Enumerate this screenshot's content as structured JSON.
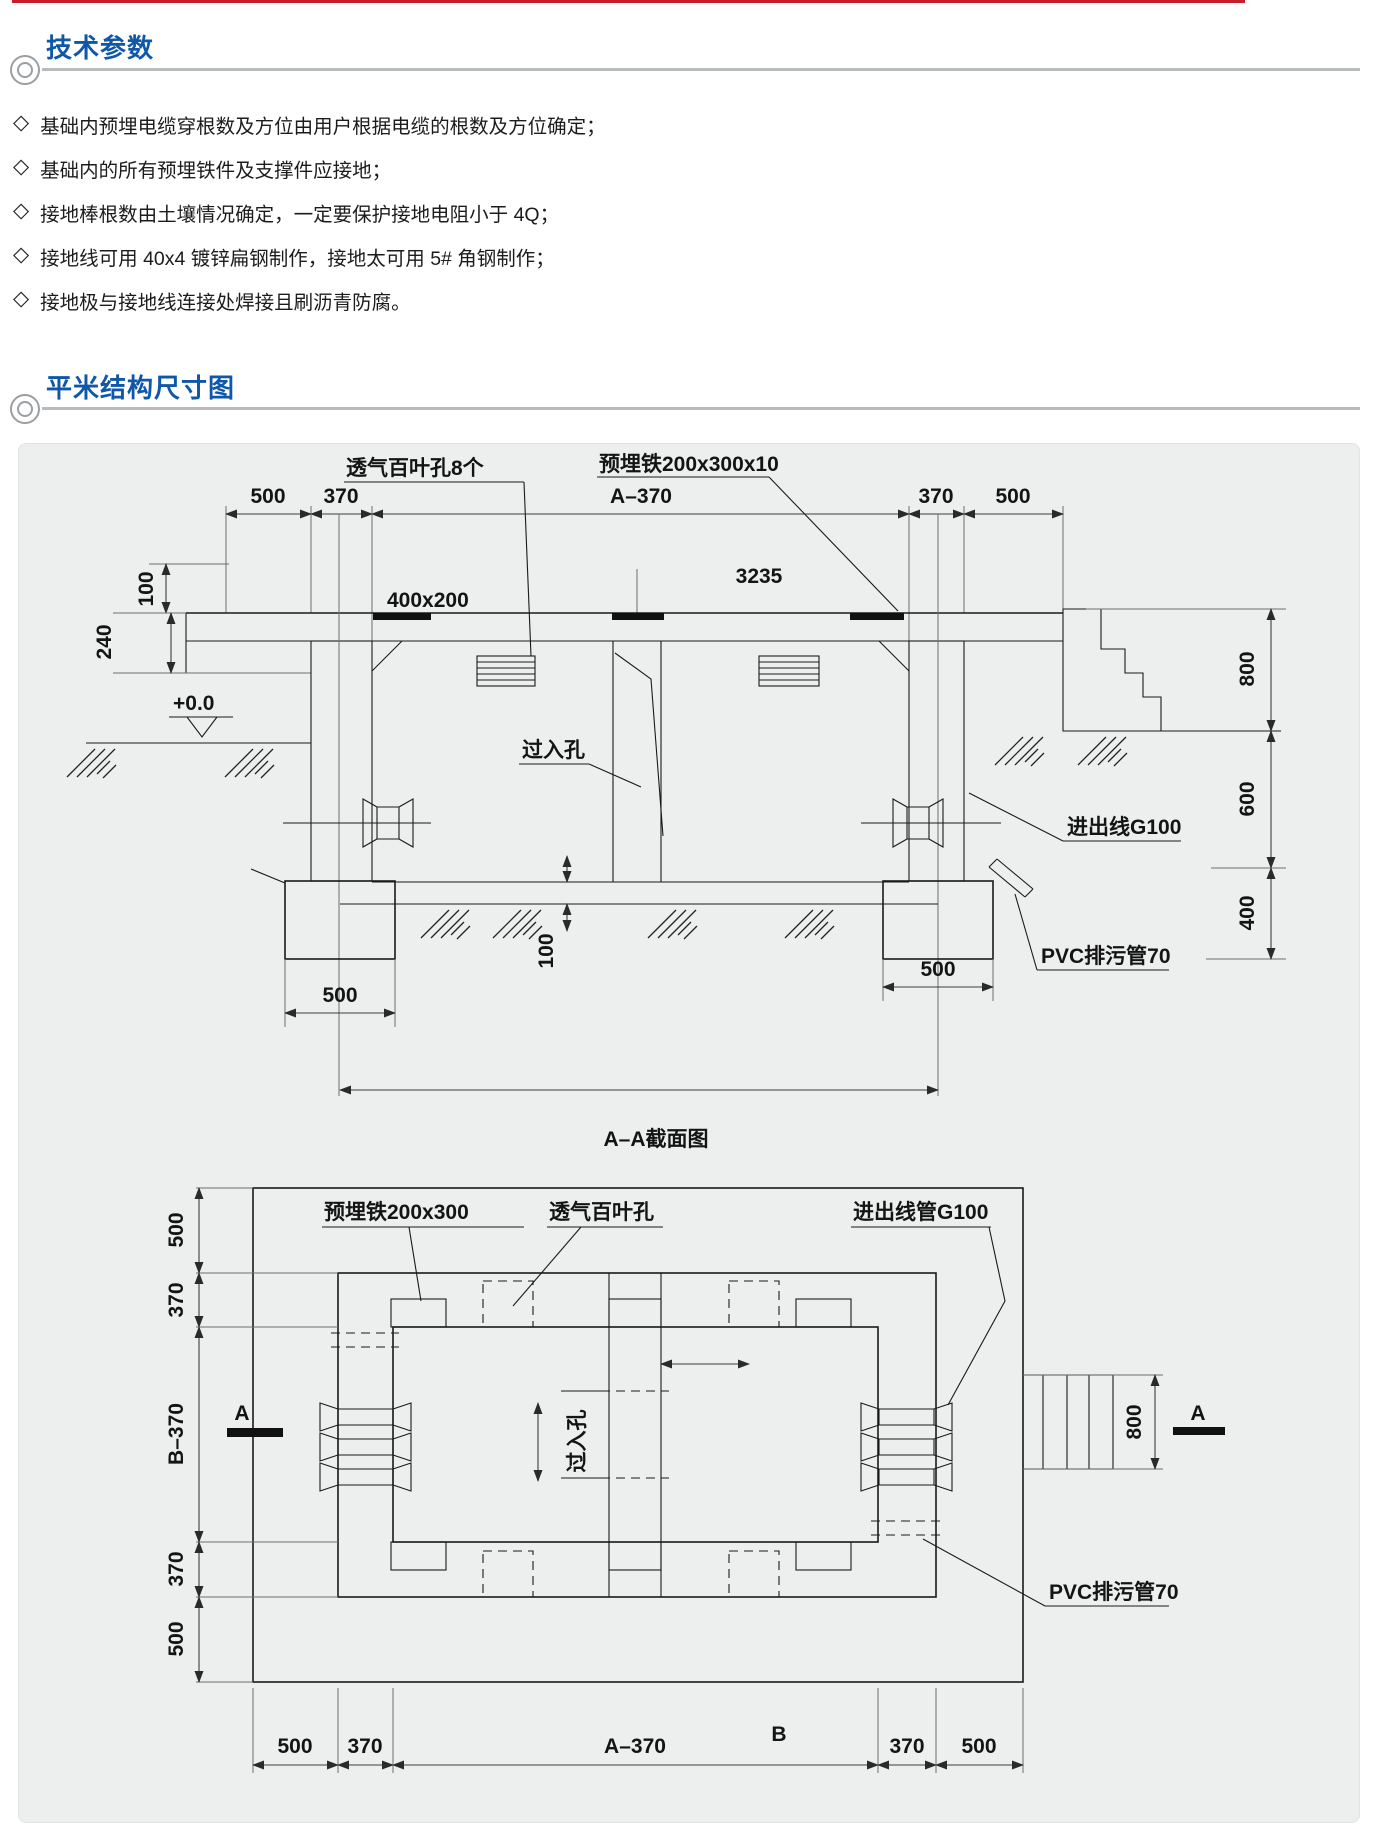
{
  "header": {
    "section1_title": "技术参数",
    "section2_title": "平米结构尺寸图",
    "bullet_char": "◇"
  },
  "bullets": [
    "基础内预埋电缆穿根数及方位由用户根据电缆的根数及方位确定；",
    "基础内的所有预埋铁件及支撑件应接地；",
    "接地棒根数由土壤情况确定，一定要保护接地电阻小于 4Q；",
    "接地线可用 40x4 镀锌扁钢制作，接地太可用 5# 角钢制作；",
    "接地极与接地线连接处焊接且刷沥青防腐。"
  ],
  "section_view": {
    "caption": "A–A截面图",
    "top_dims": [
      "500",
      "370",
      "A–370",
      "370",
      "500"
    ],
    "dim_100_roof": "100",
    "dim_240": "240",
    "level": "+0.0",
    "plate_size": "400x200",
    "total": "3235",
    "louver_label": "透气百叶孔8个",
    "plate_label": "预埋铁200x300x10",
    "manhole_label": "过入孔",
    "cable_label": "进出线G100",
    "pvc_label": "PVC排污管70",
    "right_dims": [
      "800",
      "600",
      "400"
    ],
    "footing_dim_left": "500",
    "footing_dim_right": "500",
    "floor_dim": "100"
  },
  "plan_view": {
    "label_b": "B",
    "left_dims": [
      "500",
      "370",
      "B–370",
      "370",
      "500"
    ],
    "bottom_dims": [
      "500",
      "370",
      "A–370",
      "370",
      "500"
    ],
    "plate_label": "预埋铁200x300",
    "louver_label": "透气百叶孔",
    "conduit_label": "进出线管G100",
    "pvc_label": "PVC排污管70",
    "manhole_label": "过入孔",
    "dim_800": "800",
    "marker_left": "A",
    "marker_right": "A"
  }
}
